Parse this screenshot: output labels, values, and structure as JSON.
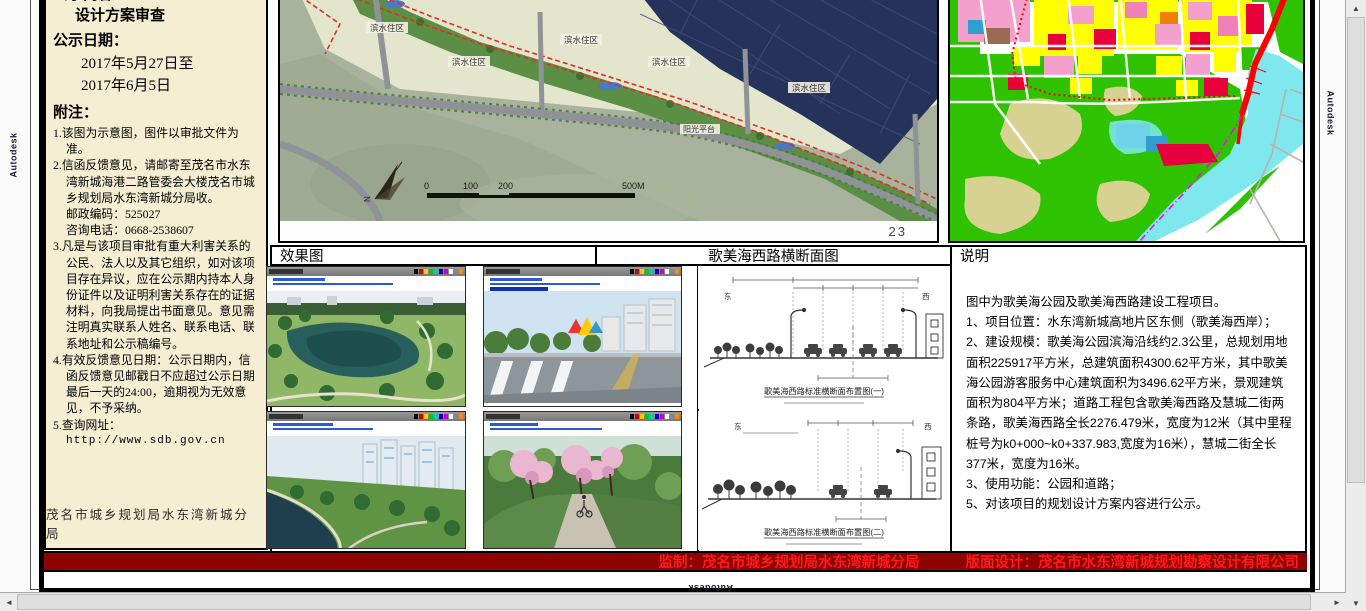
{
  "chrome": {
    "watermark": "Autodesk",
    "scroll_up": "▲",
    "scroll_down": "▼",
    "scroll_left": "◄",
    "scroll_right": "►"
  },
  "left_panel": {
    "top_partial": "公示内容：",
    "review_line": "设计方案审查",
    "date_label": "公示日期：",
    "date1": "2017年5月27日至",
    "date2": "2017年6月5日",
    "notes_label": "附注：",
    "note1": "1.该图为示意图，图件以审批文件为准。",
    "note2a": "2.信函反馈意见，请邮寄至茂名市水东湾新城海港二路管委会大楼茂名市城乡规划局水东湾新城分局收。",
    "note2b": "邮政编码：525027",
    "note2c": "咨询电话：0668-2538607",
    "note3": "3.凡是与该项目审批有重大利害关系的公民、法人以及其它组织，如对该项目存在异议，应在公示期内持本人身份证件以及证明利害关系存在的证据材料，向我局提出书面意见。意见需注明真实联系人姓名、联系电话、联系地址和公示稿编号。",
    "note4": "4.有效反馈意见日期：公示日期内，信函反馈意见邮戳日不应超过公示日期最后一天的24:00，逾期视为无效意见，不予采纳。",
    "note5a": "5.查询网址：",
    "note5b": "http://www.sdb.gov.cn",
    "footer": "茂名市城乡规划局水东湾新城分局"
  },
  "site_map": {
    "labels": [
      "滨水住区",
      "滨水住区",
      "滨水住区",
      "滨水住区",
      "滨水住区"
    ],
    "label_platform": "阳光平台",
    "north": "N",
    "scale_ticks": [
      "0",
      "100",
      "200",
      "500M"
    ],
    "page_no": "23"
  },
  "headers": {
    "renderings": "效果图",
    "cross_section": "歌美海西路横断面图",
    "description": "说明"
  },
  "cross_sections": {
    "east": "东",
    "west": "西",
    "caption1": "歌美海西路标准横断面布置图(一)",
    "caption2": "歌美海西路标准横断面布置图(二)"
  },
  "description": {
    "intro": "图中为歌美海公园及歌美海西路建设工程项目。",
    "item1": "1、项目位置：水东湾新城高地片区东侧（歌美海西岸）；",
    "item2": "2、建设规模：歌美海公园滨海沿线约2.3公里，总规划用地面积225917平方米，总建筑面积4300.62平方米，其中歌美海公园游客服务中心建筑面积为3496.62平方米，景观建筑面积为804平方米；道路工程包含歌美海西路及慧城二街两条路，歌美海西路全长2276.479米，宽度为12米（其中里程桩号为k0+000~k0+337.983,宽度为16米），慧城二街全长377米，宽度为16米。",
    "item3": "3、使用功能：公园和道路；",
    "item5": "5、对该项目的规划设计方案内容进行公示。"
  },
  "banner": {
    "supervisor": "监制：茂名市城乡规划局水东湾新城分局",
    "design": "版面设计：茂名市水东湾新城规划勘察设计有限公司"
  },
  "colors": {
    "panel_bg": "#f6eed3",
    "banner_bg": "#8e0202",
    "banner_text": "#ff1a1a",
    "water": "#25335a",
    "park_green": "#5c8f46",
    "boundary_red": "#e0301e",
    "zoning_green": "#2ec200",
    "zoning_yellow": "#ffff00",
    "zoning_pink": "#f4a0cc",
    "zoning_red": "#e8003c",
    "river_cyan": "#7fe8ee"
  }
}
